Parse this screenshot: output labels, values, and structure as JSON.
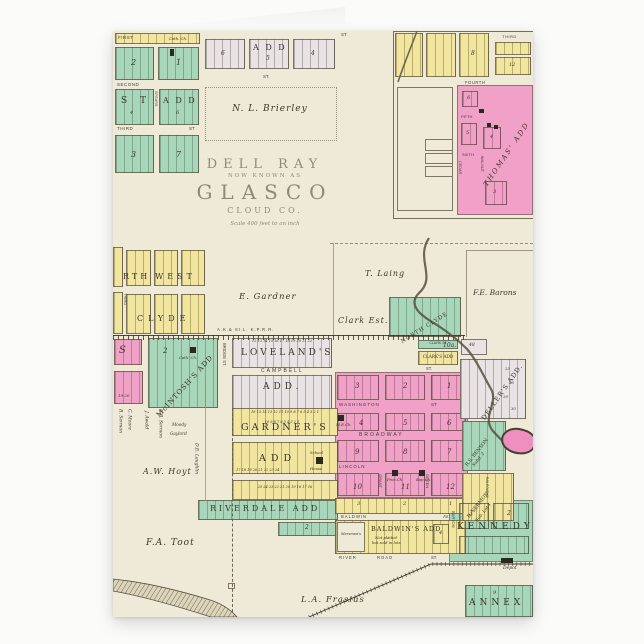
{
  "product": {
    "type": "folded greeting card with antique plat map"
  },
  "colors": {
    "paper": "#efead8",
    "pink": "#f1a0c7",
    "green": "#a7d7ba",
    "yellow": "#f2e59e",
    "lavender": "#e9e3e6",
    "ink": "#3b362a",
    "title": "#8e897b"
  },
  "titles": {
    "dellRay": "DELL RAY",
    "nowKnownAs": "NOW KNOWN AS",
    "glasco": "GLASCO",
    "county": "CLOUD CO.",
    "scale": "Scale 400 feet to an inch"
  },
  "additions": {
    "st": "S T",
    "stAdd": "A D D",
    "spears": "SPEARS",
    "topAdd": "A D D",
    "thomas": "THOMAS' ADD",
    "rth": "RTH",
    "west": "WEST",
    "clyde": "CLYDE",
    "northClyde": "NORTH CLYDE",
    "mcintosh": "McINTOSH'S ADD",
    "loveland": "LOVELAND'S",
    "lovelandAdd": "ADD.",
    "gardner": "GARDNER'S",
    "gardnerAdd": "ADD",
    "riverdale": "RIVERDALE ADD",
    "baldwins": "BALDWIN'S ADD",
    "baldwinsNote1": "Not platted",
    "baldwinsNote2": "but sold in lots",
    "mersmans": "Mersman's",
    "kennedy": "KENNEDY",
    "annex": "ANNEX",
    "clarkSt": "CLARK ST",
    "clarksAdd": "CLARK'S ADD",
    "dellers": "DELLER'S ADD.",
    "benson": "R.S. BENSON",
    "bensonSub": "Subd. 2",
    "sermon": "R. SERMON",
    "sermonSub": "Sub. Lot 1"
  },
  "streets": {
    "first": "FIRST",
    "second": "SECOND",
    "third": "THIRD",
    "st": "ST",
    "stDot": "ST.",
    "fourth": "FOURTH",
    "fifth": "FIFTH",
    "sixth": "SIXTH",
    "cedar": "CEDAR",
    "walnut": "WALNUT",
    "bridge": "BRIDGE ST.",
    "campbell": "CAMPBELL",
    "washington": "WASHINGTON",
    "broadway": "BROADWAY",
    "lincoln": "LINCOLN",
    "grant": "GRANT",
    "green": "GREEN",
    "baldwin": "BALDWIN",
    "av": "AV.",
    "river": "RIVER",
    "road": "ROAD",
    "barton": "BARTON",
    "railroadAv": "RAILROAD AV"
  },
  "owners": {
    "brierley": "N. L. Brierley",
    "gardner": "E. Gardner",
    "laing": "T. Laing",
    "clarkEst": "Clark Est.",
    "barons": "F.E. Barons",
    "toot": "F.A. Toot",
    "frasius": "L.A. Frasius",
    "hoyt": "A.W. Hoyt",
    "awald": "J. Awald",
    "rrSermon": "R.R. Sermon",
    "moore": "C. Moore",
    "sermon": "R. Sermon",
    "laughlin": "D.E. Laughlin",
    "gaylord": "Gaylord",
    "moody": "Moody"
  },
  "landmarks": {
    "cathCh": "Cath. Ch.",
    "meCh": "M.E.Ch.",
    "presCh": "Pres.Ch.",
    "bapCh": "Bap.Ch.",
    "school1": "School",
    "school2": "House",
    "depot": "Depot",
    "acres": "10a.",
    "railroad": "A.K.& St.L. K.P.R.R."
  },
  "nums": {
    "n1": "1",
    "n2": "2",
    "n3": "3",
    "n4": "4",
    "n5": "5",
    "n6": "6",
    "n7": "7",
    "n8": "8",
    "n9": "9",
    "n10": "10",
    "n11": "11",
    "n12": "12",
    "n48": "48",
    "s": "S",
    "n19_20": "19  20",
    "n23": "23",
    "n26": "26",
    "n29": "29",
    "n30": "30"
  },
  "lotRows": {
    "lovelandTop": "12 13 14 15 16 17 18 19 20 21 22",
    "lovelandBottom": "10 9 8 7 6 5 4 3 2 1",
    "gardnerTop": "16 15 14 13 12 11 10 9 8 7 6 5 4 3 2 1",
    "gardnerMid": "17 18 19 20 21 22 23 24",
    "gardnerBottom": "25 24 23 22 21 20 19 18 17 16"
  }
}
